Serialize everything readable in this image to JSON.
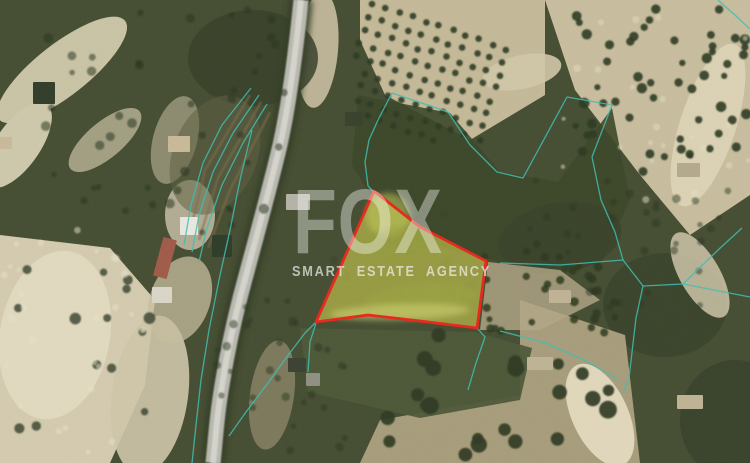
{
  "watermark": {
    "brand": "FOX",
    "tagline": "SMART ESTATE AGENCY"
  },
  "map": {
    "width": 750,
    "height": 463,
    "base_color": "#454d33",
    "grain_opacity": 0.1,
    "terrain": [
      {
        "shape": "ellipse",
        "cx": 62,
        "cy": 70,
        "rx": 80,
        "ry": 26,
        "rot": -38,
        "fill": "#c8c2a4",
        "op": 1,
        "blur": "lg"
      },
      {
        "shape": "ellipse",
        "cx": 18,
        "cy": 145,
        "rx": 50,
        "ry": 22,
        "rot": -55,
        "fill": "#ccc6a9",
        "op": 1,
        "blur": "lg"
      },
      {
        "shape": "ellipse",
        "cx": 105,
        "cy": 140,
        "rx": 45,
        "ry": 18,
        "rot": -40,
        "fill": "#b7b293",
        "op": 0.8,
        "blur": "lg"
      },
      {
        "shape": "poly",
        "pts": [
          [
            0,
            235
          ],
          [
            110,
            248
          ],
          [
            155,
            300
          ],
          [
            145,
            385
          ],
          [
            110,
            463
          ],
          [
            0,
            463
          ]
        ],
        "fill": "#d2c9ad",
        "op": 1,
        "blur": "lg"
      },
      {
        "shape": "ellipse",
        "cx": 55,
        "cy": 335,
        "rx": 55,
        "ry": 85,
        "rot": 10,
        "fill": "#e2dac0",
        "op": 0.85,
        "blur": "lg"
      },
      {
        "shape": "ellipse",
        "cx": 150,
        "cy": 395,
        "rx": 38,
        "ry": 80,
        "rot": 8,
        "fill": "#cdc4a6",
        "op": 0.9,
        "blur": "lg"
      },
      {
        "shape": "ellipse",
        "cx": 180,
        "cy": 300,
        "rx": 30,
        "ry": 45,
        "rot": 20,
        "fill": "#c5bb9c",
        "op": 0.75,
        "blur": "lg"
      },
      {
        "shape": "ellipse",
        "cx": 175,
        "cy": 140,
        "rx": 22,
        "ry": 45,
        "rot": 15,
        "fill": "#b9b095",
        "op": 0.6,
        "blur": "sm"
      },
      {
        "shape": "ellipse",
        "cx": 190,
        "cy": 215,
        "rx": 25,
        "ry": 35,
        "rot": 0,
        "fill": "#c9c2a8",
        "op": 0.8,
        "blur": "sm"
      },
      {
        "shape": "ellipse",
        "cx": 318,
        "cy": 50,
        "rx": 20,
        "ry": 58,
        "rot": 5,
        "fill": "#c6bd9f",
        "op": 0.9,
        "blur": "sm"
      },
      {
        "shape": "poly",
        "pts": [
          [
            360,
            0
          ],
          [
            545,
            0
          ],
          [
            545,
            95
          ],
          [
            470,
            140
          ],
          [
            385,
            95
          ],
          [
            360,
            40
          ]
        ],
        "fill": "#c2b795",
        "op": 1,
        "blur": "lg"
      },
      {
        "shape": "poly",
        "pts": [
          [
            545,
            0
          ],
          [
            750,
            0
          ],
          [
            750,
            195
          ],
          [
            690,
            235
          ],
          [
            640,
            175
          ],
          [
            575,
            90
          ]
        ],
        "fill": "#c6bb9c",
        "op": 1,
        "blur": "lg"
      },
      {
        "shape": "ellipse",
        "cx": 708,
        "cy": 125,
        "rx": 28,
        "ry": 85,
        "rot": 18,
        "fill": "#ddd3b6",
        "op": 0.85,
        "blur": "sm"
      },
      {
        "shape": "ellipse",
        "cx": 522,
        "cy": 72,
        "rx": 40,
        "ry": 17,
        "rot": -12,
        "fill": "#cfc5a6",
        "op": 0.9,
        "blur": "sm"
      },
      {
        "shape": "ellipse",
        "cx": 253,
        "cy": 58,
        "rx": 65,
        "ry": 48,
        "rot": 0,
        "fill": "#38412a",
        "op": 0.85,
        "blur": "lg"
      },
      {
        "shape": "poly",
        "pts": [
          [
            358,
            95
          ],
          [
            450,
            113
          ],
          [
            500,
            172
          ],
          [
            558,
            182
          ],
          [
            612,
            108
          ],
          [
            630,
            200
          ],
          [
            600,
            265
          ],
          [
            500,
            262
          ],
          [
            395,
            235
          ],
          [
            352,
            165
          ]
        ],
        "fill": "#3c4729",
        "op": 0.9,
        "blur": "lg"
      },
      {
        "shape": "ellipse",
        "cx": 560,
        "cy": 238,
        "rx": 62,
        "ry": 35,
        "rot": -10,
        "fill": "#39432b",
        "op": 0.85,
        "blur": "lg"
      },
      {
        "shape": "ellipse",
        "cx": 665,
        "cy": 305,
        "rx": 62,
        "ry": 52,
        "rot": 0,
        "fill": "#39432b",
        "op": 0.85,
        "blur": "lg"
      },
      {
        "shape": "ellipse",
        "cx": 735,
        "cy": 420,
        "rx": 55,
        "ry": 60,
        "rot": 0,
        "fill": "#38422b",
        "op": 0.85,
        "blur": "lg"
      },
      {
        "shape": "poly",
        "pts": [
          [
            520,
            300
          ],
          [
            625,
            335
          ],
          [
            640,
            463
          ],
          [
            360,
            463
          ],
          [
            380,
            420
          ],
          [
            520,
            395
          ]
        ],
        "fill": "#ab9f7e",
        "op": 0.95,
        "blur": "lg"
      },
      {
        "shape": "poly",
        "pts": [
          [
            488,
            262
          ],
          [
            560,
            270
          ],
          [
            600,
            300
          ],
          [
            540,
            330
          ],
          [
            480,
            330
          ]
        ],
        "fill": "#b0a585",
        "op": 0.8,
        "blur": "lg"
      },
      {
        "shape": "poly",
        "pts": [
          [
            300,
            328
          ],
          [
            475,
            332
          ],
          [
            532,
            348
          ],
          [
            520,
            400
          ],
          [
            420,
            418
          ],
          [
            308,
            392
          ]
        ],
        "fill": "#4d5739",
        "op": 0.95,
        "blur": "lg"
      },
      {
        "shape": "ellipse",
        "cx": 272,
        "cy": 395,
        "rx": 22,
        "ry": 55,
        "rot": 8,
        "fill": "#a09577",
        "op": 0.6,
        "blur": "lg"
      },
      {
        "shape": "ellipse",
        "cx": 215,
        "cy": 155,
        "rx": 42,
        "ry": 62,
        "rot": 22,
        "fill": "#5c5f41",
        "op": 0.55,
        "blur": "lg"
      },
      {
        "shape": "ellipse",
        "cx": 600,
        "cy": 415,
        "rx": 28,
        "ry": 55,
        "rot": -25,
        "fill": "#e5dcc0",
        "op": 0.9,
        "blur": "sm"
      },
      {
        "shape": "ellipse",
        "cx": 700,
        "cy": 275,
        "rx": 20,
        "ry": 48,
        "rot": -30,
        "fill": "#d5cbae",
        "op": 0.8,
        "blur": "sm"
      }
    ],
    "terrace_strokes": {
      "color": "#7d6b4c",
      "width": 2.5,
      "opacity": 0.6,
      "lines": [
        [
          [
            250,
            95
          ],
          [
            205,
            170
          ],
          [
            190,
            232
          ]
        ],
        [
          [
            261,
            102
          ],
          [
            218,
            178
          ],
          [
            199,
            240
          ]
        ],
        [
          [
            270,
            112
          ],
          [
            230,
            190
          ],
          [
            208,
            248
          ]
        ]
      ]
    },
    "road": {
      "path": "M301,0 C296,50 290,100 280,145 C268,196 252,252 240,298 C231,333 224,370 219,405 C216,428 215,445 213,463",
      "under_color": "#333c26",
      "under_width": 24,
      "main_color": "#b7b7af",
      "main_width": 15,
      "center_color": "#d6d6cd",
      "center_width": 6
    },
    "groves": [
      {
        "type": "grid",
        "seed": 11,
        "origin": [
          372,
          4
        ],
        "col_step": [
          13.5,
          4.5
        ],
        "row_step": [
          -4,
          13
        ],
        "cols": 11,
        "rows": 9,
        "jitter": 1.6,
        "r": 3.3,
        "fill": "#2e3a22",
        "op": 0.9,
        "clip": [
          356,
          0,
          192,
          142
        ]
      },
      {
        "type": "scatter",
        "seed": 21,
        "rect": [
          575,
          0,
          175,
          185
        ],
        "n": 55,
        "rmin": 3,
        "rmax": 5.5,
        "fill": "#2e3a22",
        "op": 0.9
      },
      {
        "type": "scatter",
        "seed": 31,
        "rect": [
          480,
          240,
          140,
          95
        ],
        "n": 30,
        "rmin": 3,
        "rmax": 4.5,
        "fill": "#2e3a22",
        "op": 0.85
      },
      {
        "type": "scatter",
        "seed": 41,
        "rect": [
          380,
          335,
          250,
          125
        ],
        "n": 22,
        "rmin": 5.5,
        "rmax": 9,
        "fill": "#313b25",
        "op": 0.92
      },
      {
        "type": "scatter",
        "seed": 51,
        "rect": [
          5,
          255,
          150,
          200
        ],
        "n": 14,
        "rmin": 3.5,
        "rmax": 6,
        "fill": "#35402a",
        "op": 0.8
      },
      {
        "type": "scatter",
        "seed": 61,
        "rect": [
          45,
          5,
          255,
          235
        ],
        "n": 45,
        "rmin": 2.5,
        "rmax": 5,
        "fill": "#2c3620",
        "op": 0.55
      },
      {
        "type": "scatter",
        "seed": 71,
        "rect": [
          520,
          180,
          230,
          130
        ],
        "n": 35,
        "rmin": 2.5,
        "rmax": 4.5,
        "fill": "#2c3620",
        "op": 0.5
      },
      {
        "type": "scatter",
        "seed": 81,
        "rect": [
          210,
          300,
          140,
          160
        ],
        "n": 30,
        "rmin": 2.5,
        "rmax": 4.5,
        "fill": "#2e3823",
        "op": 0.5
      },
      {
        "type": "scatter",
        "seed": 91,
        "rect": [
          330,
          210,
          140,
          100
        ],
        "n": 18,
        "rmin": 3,
        "rmax": 6,
        "fill": "#39422a",
        "op": 0.5
      },
      {
        "type": "scatter",
        "seed": 101,
        "rect": [
          0,
          230,
          150,
          230
        ],
        "n": 28,
        "rmin": 2,
        "rmax": 4,
        "fill": "#e8e1c6",
        "op": 0.5
      },
      {
        "type": "scatter",
        "seed": 111,
        "rect": [
          550,
          0,
          200,
          200
        ],
        "n": 22,
        "rmin": 2,
        "rmax": 4,
        "fill": "#e4dcc0",
        "op": 0.5
      }
    ],
    "buildings": [
      {
        "x": 180,
        "y": 217,
        "w": 18,
        "h": 18,
        "fill": "#e8e6df",
        "rot": 0
      },
      {
        "x": 158,
        "y": 238,
        "w": 14,
        "h": 40,
        "fill": "#9e5a48",
        "rot": 15
      },
      {
        "x": 152,
        "y": 287,
        "w": 20,
        "h": 16,
        "fill": "#d8d4c6",
        "rot": 0
      },
      {
        "x": 212,
        "y": 235,
        "w": 20,
        "h": 22,
        "fill": "#2f3d2a",
        "rot": 0
      },
      {
        "x": 168,
        "y": 136,
        "w": 22,
        "h": 16,
        "fill": "#c7b896",
        "rot": 0
      },
      {
        "x": 0,
        "y": 137,
        "w": 12,
        "h": 12,
        "fill": "#c7b896",
        "rot": 0
      },
      {
        "x": 286,
        "y": 194,
        "w": 24,
        "h": 16,
        "fill": "#b3b1a6",
        "rot": 0
      },
      {
        "x": 288,
        "y": 358,
        "w": 18,
        "h": 14,
        "fill": "#3c4132",
        "rot": 0
      },
      {
        "x": 306,
        "y": 373,
        "w": 14,
        "h": 13,
        "fill": "#8d8d82",
        "rot": 0
      },
      {
        "x": 549,
        "y": 290,
        "w": 22,
        "h": 13,
        "fill": "#bdb192",
        "rot": 0
      },
      {
        "x": 527,
        "y": 357,
        "w": 26,
        "h": 13,
        "fill": "#bdb192",
        "rot": 0
      },
      {
        "x": 677,
        "y": 395,
        "w": 26,
        "h": 14,
        "fill": "#bdb192",
        "rot": 0
      },
      {
        "x": 677,
        "y": 163,
        "w": 23,
        "h": 14,
        "fill": "#b3a78a",
        "rot": 0
      },
      {
        "x": 33,
        "y": 82,
        "w": 22,
        "h": 22,
        "fill": "#333d2b",
        "rot": 0
      },
      {
        "x": 345,
        "y": 112,
        "w": 18,
        "h": 14,
        "fill": "#39422c",
        "rot": 0
      }
    ],
    "cadastral": {
      "color": "#3fbcae",
      "width": 1.3,
      "opacity": 0.85,
      "lines": [
        [
          [
            252,
            130
          ],
          [
            240,
            180
          ],
          [
            230,
            230
          ],
          [
            219,
            280
          ],
          [
            209,
            330
          ],
          [
            201,
            380
          ],
          [
            196,
            425
          ],
          [
            192,
            463
          ]
        ],
        [
          [
            251,
            88
          ],
          [
            222,
            125
          ],
          [
            203,
            163
          ],
          [
            191,
            205
          ],
          [
            184,
            245
          ]
        ],
        [
          [
            259,
            95
          ],
          [
            233,
            133
          ],
          [
            213,
            172
          ],
          [
            199,
            215
          ],
          [
            192,
            252
          ]
        ],
        [
          [
            267,
            104
          ],
          [
            243,
            143
          ],
          [
            222,
            185
          ],
          [
            207,
            228
          ],
          [
            199,
            262
          ]
        ],
        [
          [
            392,
            93
          ],
          [
            448,
            112
          ],
          [
            470,
            145
          ],
          [
            497,
            172
          ],
          [
            523,
            178
          ],
          [
            567,
            97
          ],
          [
            612,
            105
          ]
        ],
        [
          [
            392,
            93
          ],
          [
            378,
            120
          ],
          [
            369,
            140
          ],
          [
            365,
            162
          ],
          [
            368,
            186
          ],
          [
            374,
            192
          ]
        ],
        [
          [
            612,
            105
          ],
          [
            592,
            157
          ],
          [
            601,
            200
          ],
          [
            615,
            232
          ],
          [
            623,
            260
          ]
        ],
        [
          [
            500,
            263
          ],
          [
            560,
            265
          ],
          [
            623,
            260
          ]
        ],
        [
          [
            623,
            260
          ],
          [
            643,
            286
          ],
          [
            683,
            284
          ],
          [
            750,
            297
          ]
        ],
        [
          [
            683,
            284
          ],
          [
            718,
            250
          ],
          [
            742,
            228
          ]
        ],
        [
          [
            643,
            286
          ],
          [
            636,
            318
          ],
          [
            629,
            378
          ],
          [
            623,
            393
          ]
        ],
        [
          [
            316,
            322
          ],
          [
            305,
            333
          ],
          [
            286,
            358
          ],
          [
            268,
            383
          ],
          [
            246,
            412
          ],
          [
            229,
            436
          ]
        ],
        [
          [
            316,
            323
          ],
          [
            310,
            342
          ],
          [
            308,
            372
          ]
        ],
        [
          [
            477,
            328
          ],
          [
            485,
            337
          ],
          [
            476,
            363
          ],
          [
            468,
            390
          ]
        ],
        [
          [
            500,
            331
          ],
          [
            546,
            343
          ],
          [
            586,
            361
          ],
          [
            617,
            379
          ]
        ],
        [
          [
            718,
            0
          ],
          [
            736,
            16
          ],
          [
            750,
            29
          ]
        ]
      ]
    },
    "parcel": {
      "points": [
        [
          374,
          191
        ],
        [
          420,
          227
        ],
        [
          486,
          261
        ],
        [
          477,
          328
        ],
        [
          420,
          321
        ],
        [
          368,
          315
        ],
        [
          316,
          322
        ]
      ],
      "fill": "#dede50",
      "fill_opacity": 0.52,
      "stroke": "#e8281e",
      "stroke_width": 2.8,
      "shades": [
        {
          "cx": 388,
          "cy": 215,
          "rx": 22,
          "ry": 22,
          "rot": 0,
          "fill": "#c6cc5e",
          "op": 0.5
        },
        {
          "cx": 395,
          "cy": 243,
          "rx": 35,
          "ry": 16,
          "rot": -10,
          "fill": "#8f9a3e",
          "op": 0.5
        },
        {
          "cx": 420,
          "cy": 298,
          "rx": 55,
          "ry": 14,
          "rot": -5,
          "fill": "#99a342",
          "op": 0.45
        },
        {
          "cx": 400,
          "cy": 312,
          "rx": 70,
          "ry": 8,
          "rot": -2,
          "fill": "#d7d977",
          "op": 0.5
        }
      ]
    }
  }
}
